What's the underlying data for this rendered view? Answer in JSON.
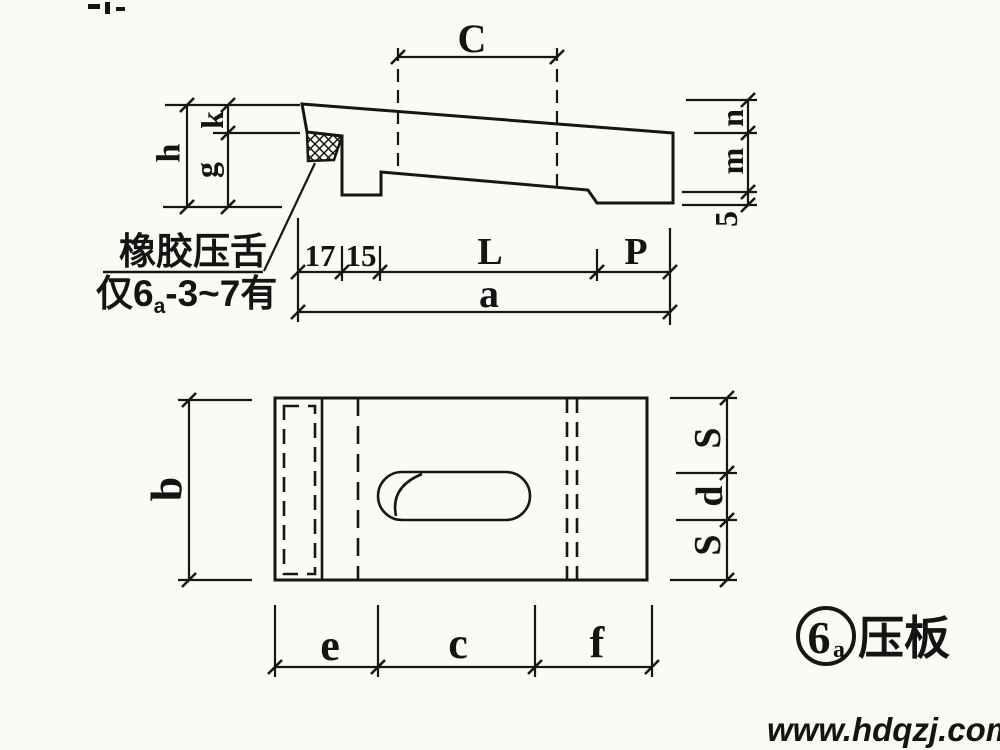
{
  "figure_type": "engineering-drawing",
  "side_view": {
    "dim_labels": {
      "c": "C",
      "h": "h",
      "k": "k",
      "g": "g",
      "n": "n",
      "m": "m",
      "step": "5",
      "d17": "17",
      "d15": "15",
      "l": "L",
      "p": "P",
      "a": "a"
    },
    "callout": {
      "line1": "橡胶压舌",
      "line2_prefix": "仅6",
      "line2_sub": "a",
      "line2_suffix": "-3~7有"
    }
  },
  "plan_view": {
    "dim_labels": {
      "b": "b",
      "s_top": "S",
      "d": "d",
      "s_bottom": "S",
      "e": "e",
      "c": "c",
      "f": "f"
    }
  },
  "figure_label": {
    "number": "6",
    "number_sub": "a",
    "name": "压板"
  },
  "watermark": {
    "text": "www.hdqzj.com",
    "color": "#2231c8"
  },
  "colors": {
    "background": "#fbfaf5",
    "line": "#161616"
  }
}
